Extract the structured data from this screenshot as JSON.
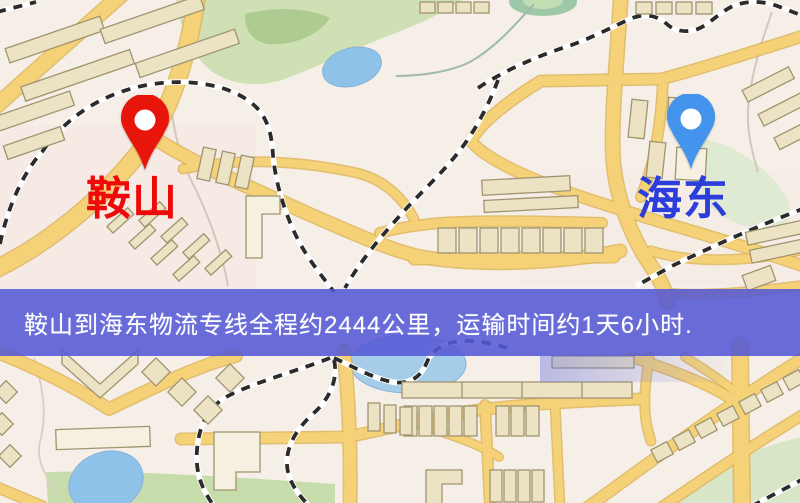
{
  "page": {
    "type": "logistics-route-map-image",
    "width": 800,
    "height": 503
  },
  "banner": {
    "text": "鞍山到海东物流专线全程约2444公里，运输时间约1天6小时.",
    "background_color": "#5458d6",
    "text_color": "#ffffff"
  },
  "route": {
    "origin_city": "鞍山",
    "destination_city": "海东",
    "distance_text": "约2444公里",
    "duration_text": "约1天6小时"
  },
  "origin": {
    "name": "鞍山",
    "label_color": "#ee0a0a",
    "pin_color": "#e8150b",
    "pin_hole_color": "#ffffff"
  },
  "destination": {
    "name": "海东",
    "label_color": "#2b3ddb",
    "pin_color": "#4493ec",
    "pin_hole_color": "#ffffff"
  },
  "map_palette": {
    "background": "#f6efe7",
    "road_fill": "#f5d278",
    "road_casing": "#dcb254",
    "building_fill": "#ece3c5",
    "building_outline": "#a0946f",
    "park_green": "#cfe0b4",
    "water_blue": "#8fc2e8",
    "railway_dash": "#2b2b2b"
  }
}
